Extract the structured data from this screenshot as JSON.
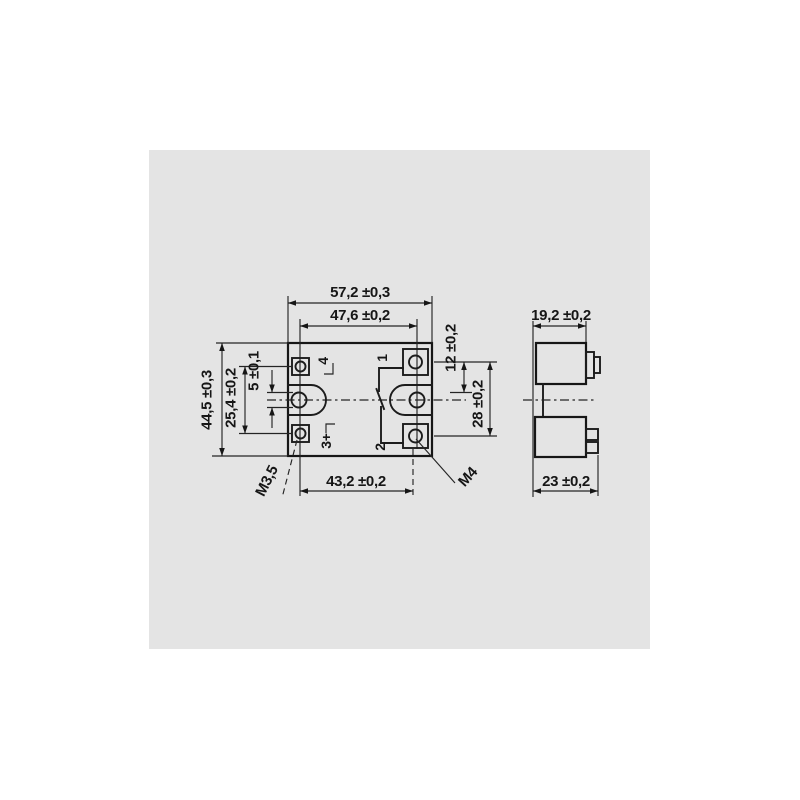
{
  "drawing": {
    "front_view": {
      "dim_body_width": "57,2 ±0,3",
      "dim_mounting_hole_span": "47,6 ±0,2",
      "dim_body_height": "44,5 ±0,3",
      "dim_input_terminal_pitch": "25,4 ±0,2",
      "dim_mounting_hole_diameter": "5 ±0,1",
      "dim_terminal1_offset": "12 ±0,2",
      "dim_output_terminal_pitch": "28 ±0,2",
      "dim_terminal_span": "43,2 ±0,2",
      "thread_input_screw": "M3,5",
      "thread_output_screw": "M4",
      "terminal_1": "1",
      "terminal_2": "2",
      "terminal_3": "3+",
      "terminal_4": "4"
    },
    "side_view": {
      "dim_body_depth": "19,2 ±0,2",
      "dim_overall_depth": "23 ±0,2"
    },
    "colors": {
      "panel": "#e4e4e4",
      "line": "#1c1c1c",
      "page": "#ffffff"
    }
  }
}
